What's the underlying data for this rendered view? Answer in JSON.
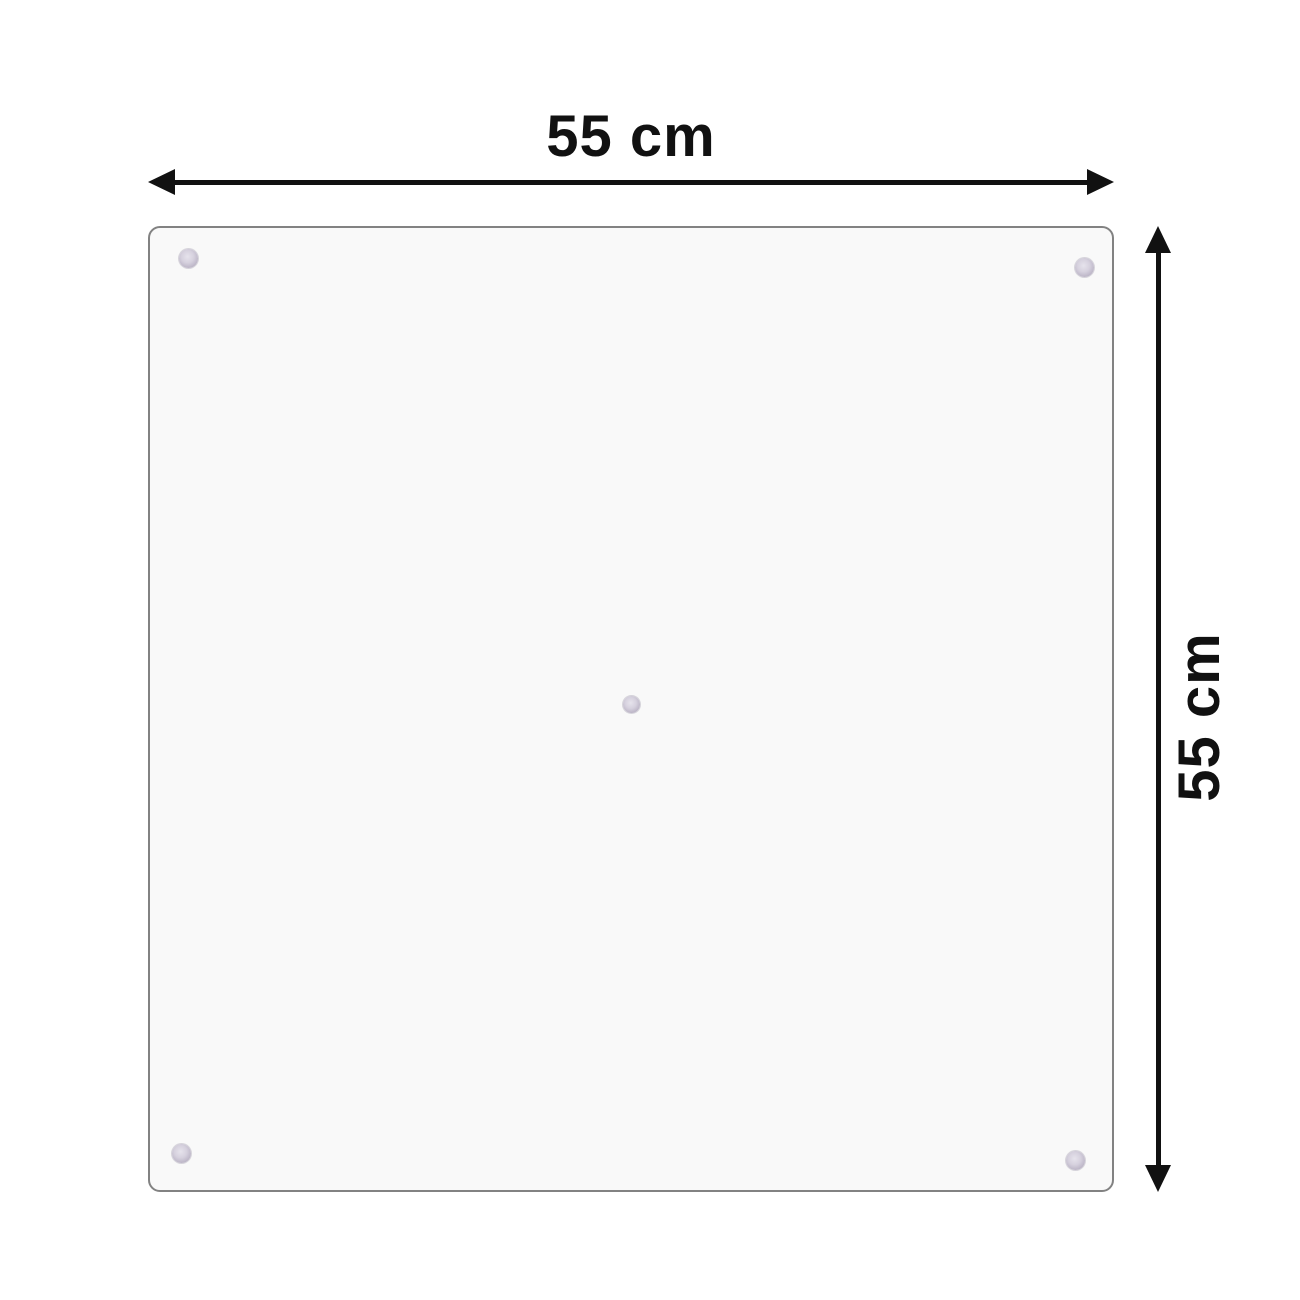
{
  "diagram": {
    "type": "product-dimension-diagram",
    "product": "transparent glass panel with suction cups",
    "dimensions": {
      "width_label": "55 cm",
      "height_label": "55 cm"
    },
    "suction_cups": {
      "count": 5,
      "positions": [
        "top-left",
        "top-right",
        "center",
        "bottom-left",
        "bottom-right"
      ]
    },
    "colors": {
      "background": "#ffffff",
      "panel_fill": "#f9f9f9",
      "panel_border": "#828282",
      "arrow_and_text": "#111111",
      "suction_cup": "#c6c0cf"
    }
  }
}
